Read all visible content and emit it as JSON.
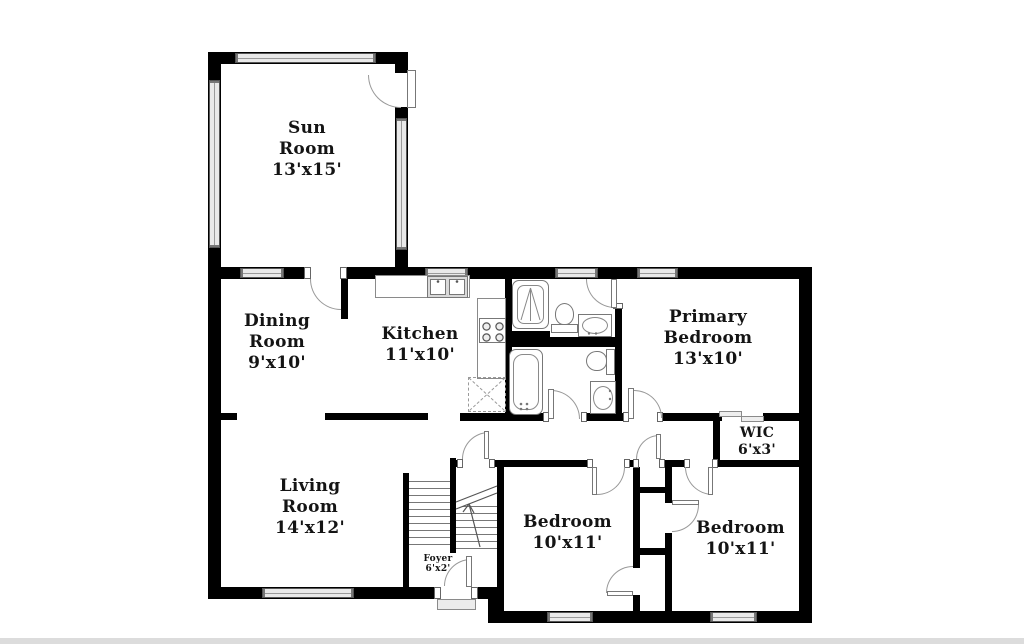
{
  "plan": {
    "type": "residential-floor-plan",
    "rooms": [
      {
        "name": "Sun Room",
        "dims": "13'x15'"
      },
      {
        "name": "Dining Room",
        "dims": "9'x10'"
      },
      {
        "name": "Kitchen",
        "dims": "11'x10'"
      },
      {
        "name": "Primary Bedroom",
        "dims": "13'x10'"
      },
      {
        "name": "WIC",
        "dims": "6'x3'"
      },
      {
        "name": "Living Room",
        "dims": "14'x12'"
      },
      {
        "name": "Foyer",
        "dims": "6'x2'"
      },
      {
        "name": "Bedroom",
        "dims": "10'x11'"
      },
      {
        "name": "Bedroom",
        "dims": "10'x11'"
      }
    ]
  },
  "colors": {
    "wall": "#000000",
    "window_fill": "#e9e9e9",
    "fixture_line": "#777777",
    "door_arc": "#999999",
    "background": "#ffffff",
    "bottom_strip": "#dcdcdc"
  }
}
